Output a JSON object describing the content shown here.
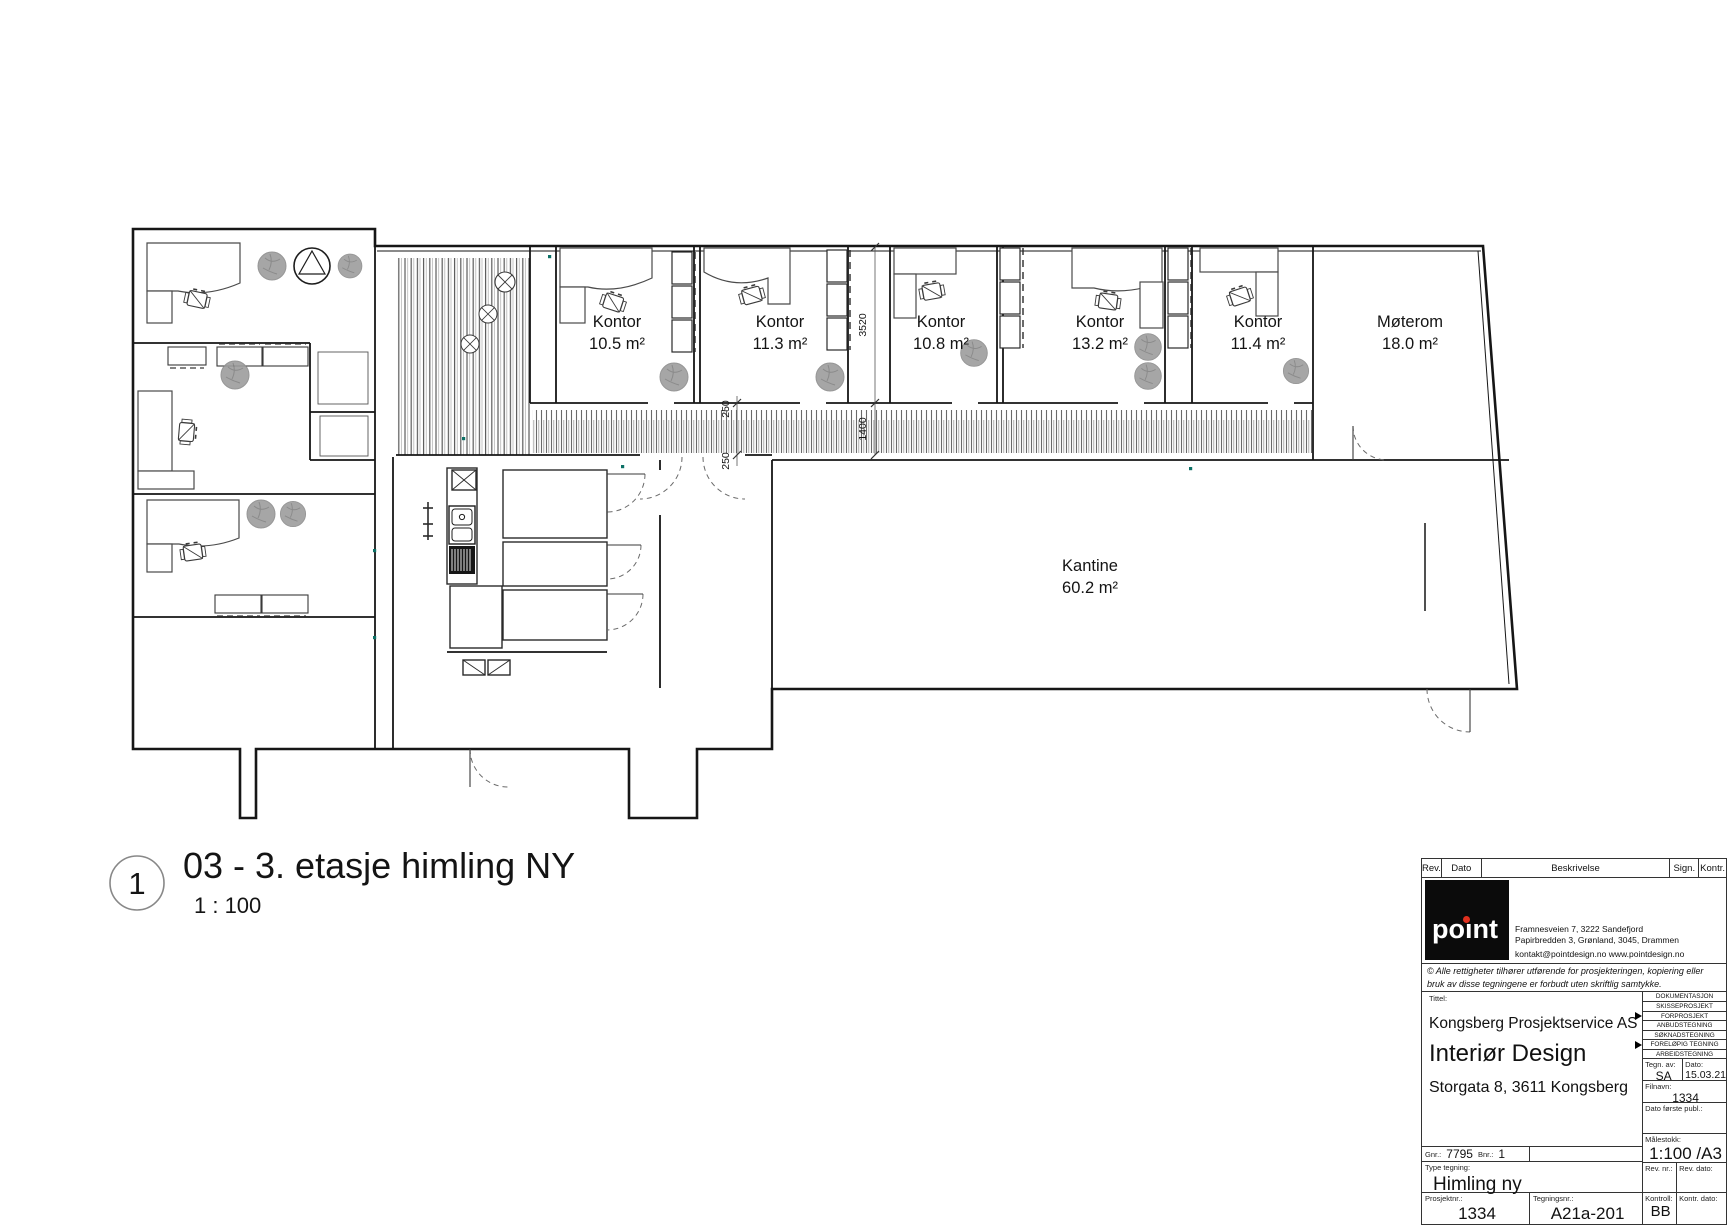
{
  "drawing": {
    "view_number": "1",
    "view_title": "03 - 3. etasje himling NY",
    "view_scale": "1 : 100",
    "rooms": [
      {
        "name": "Kontor",
        "area": "10.5 m²"
      },
      {
        "name": "Kontor",
        "area": "11.3 m²"
      },
      {
        "name": "Kontor",
        "area": "10.8 m²"
      },
      {
        "name": "Kontor",
        "area": "13.2 m²"
      },
      {
        "name": "Kontor",
        "area": "11.4 m²"
      },
      {
        "name": "Møterom",
        "area": "18.0 m²"
      },
      {
        "name": "Kantine",
        "area": "60.2 m²"
      }
    ],
    "dims": {
      "a": "250",
      "b": "250",
      "c": "1400",
      "d": "3520"
    }
  },
  "title_block": {
    "rev_header": {
      "rev": "Rev.",
      "dato": "Dato",
      "beskrivelse": "Beskrivelse",
      "sign": "Sign.",
      "kontr": "Kontr."
    },
    "logo": {
      "text": "poınt"
    },
    "company": {
      "address1": "Framnesveien 7, 3222 Sandefjord",
      "address2": "Papirbredden 3, Grønland, 3045, Drammen",
      "contact": "kontakt@pointdesign.no www.pointdesign.no"
    },
    "copyright": "© Alle rettigheter tilhører utførende for prosjekteringen, kopiering eller bruk av disse tegningene er forbudt uten skriftlig samtykke.",
    "tittel_label": "Tittel:",
    "tittel": {
      "line1": "Kongsberg Prosjektservice AS",
      "line2": "Interiør Design",
      "line3": "Storgata 8, 3611 Kongsberg"
    },
    "dokumentasjon": {
      "header": "DOKUMENTASJON",
      "items": [
        {
          "label": "SKISSEPROSJEKT",
          "marked": false
        },
        {
          "label": "FORPROSJEKT",
          "marked": true
        },
        {
          "label": "ANBUDSTEGNING",
          "marked": false
        },
        {
          "label": "SØKNADSTEGNING",
          "marked": false
        },
        {
          "label": "FORELØPIG TEGNING",
          "marked": true
        },
        {
          "label": "ARBEIDSTEGNING",
          "marked": false
        }
      ]
    },
    "fields": {
      "tegn_av_label": "Tegn. av:",
      "tegn_av": "SA",
      "dato_label": "Dato:",
      "dato": "15.03.21",
      "filnavn_label": "Filnavn:",
      "filnavn": "1334",
      "dato_publ_label": "Dato første publ.:",
      "malestokk_label": "Målestokk:",
      "malestokk": "1:100 /A3",
      "gnr_label": "Gnr.:",
      "gnr": "7795",
      "bnr_label": "Bnr.:",
      "bnr": "1",
      "type_label": "Type tegning:",
      "type": "Himling ny",
      "rev_nr_label": "Rev. nr.:",
      "rev_dato_label": "Rev. dato:",
      "prosjektnr_label": "Prosjektnr.:",
      "prosjektnr": "1334",
      "tegningsnr_label": "Tegningsnr.:",
      "tegningsnr": "A21a-201",
      "kontroll_label": "Kontroll:",
      "kontroll": "BB",
      "kontr_dato_label": "Kontr. dato:"
    }
  }
}
